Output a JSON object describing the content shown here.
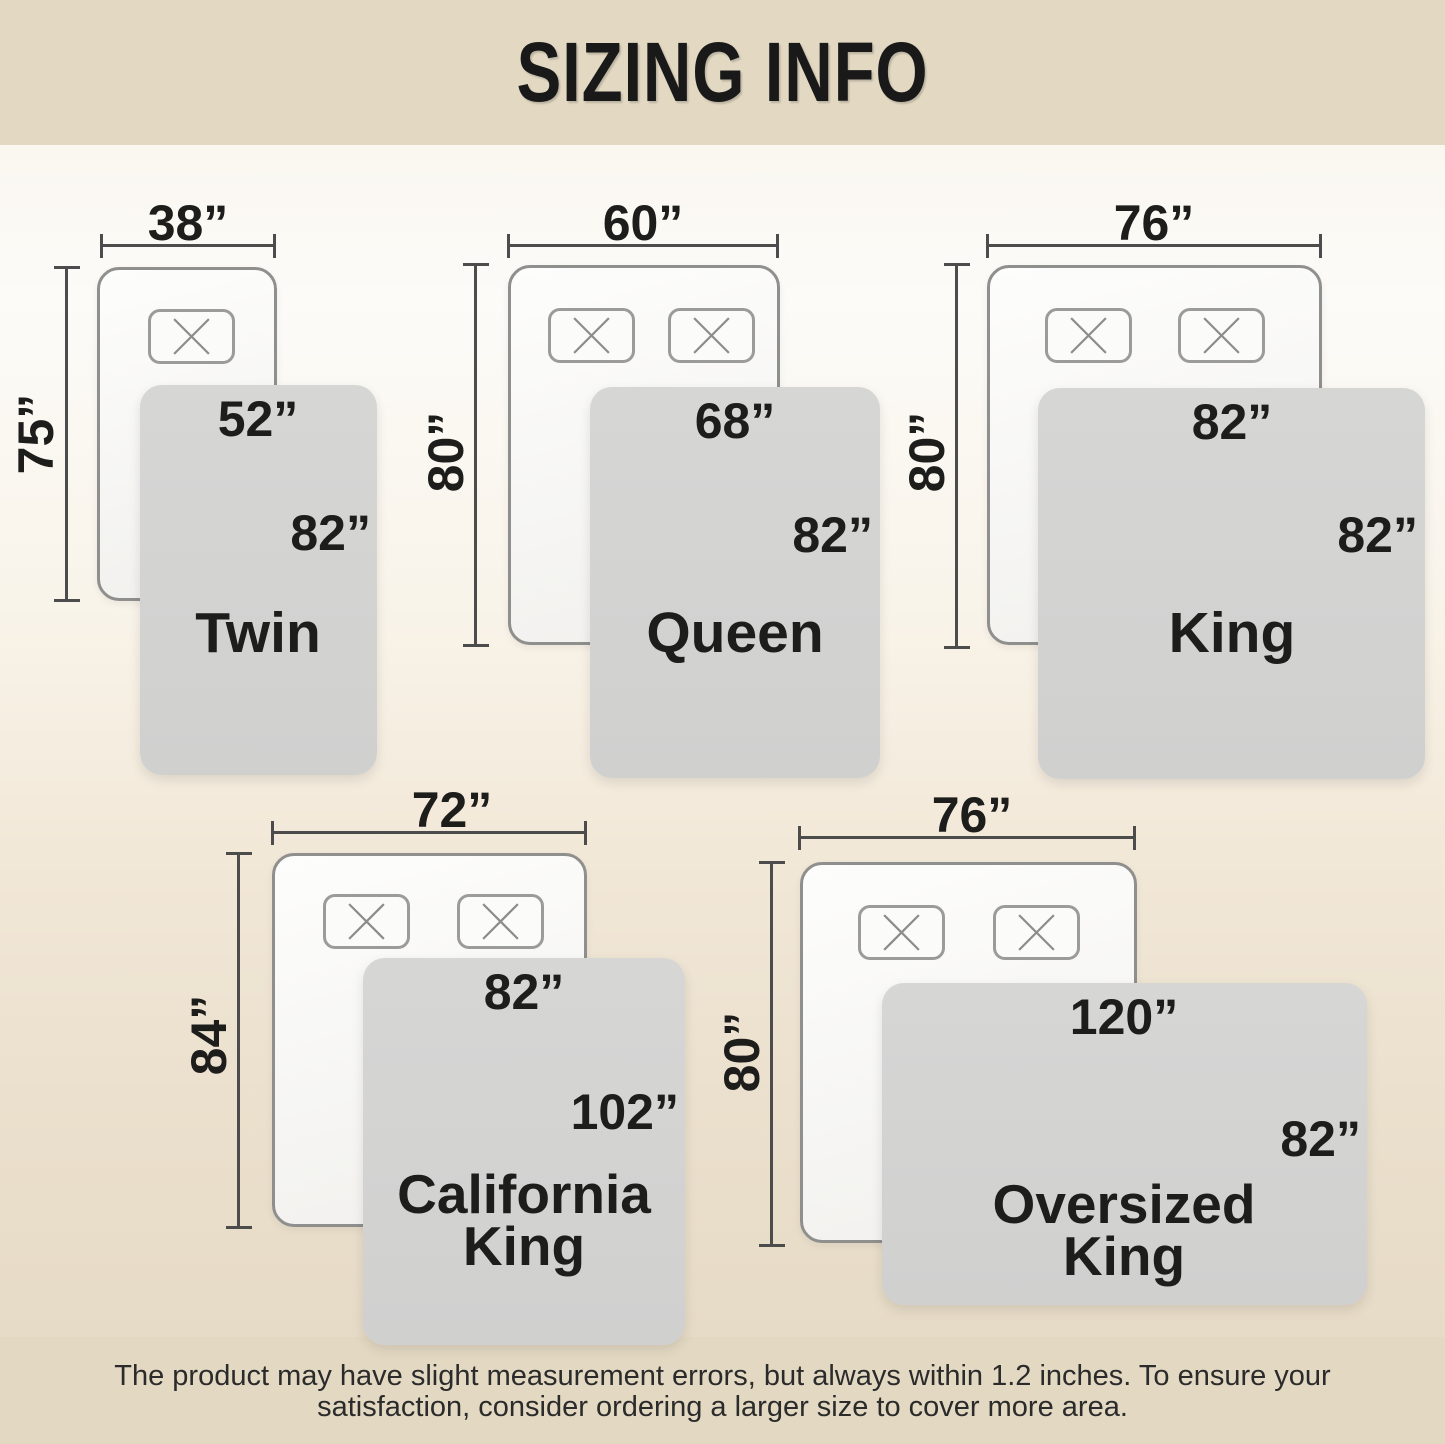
{
  "title": "SIZING INFO",
  "footer": {
    "line1": "The product may have slight measurement errors, but always within 1.2 inches. To ensure your",
    "line2": "satisfaction, consider ordering a larger size to cover more area."
  },
  "colors": {
    "band_beige": "#e3d9c3",
    "blanket_gray": "#d3d3d2",
    "dimension_line": "#4c4c4c",
    "text": "#1d1d1b"
  },
  "beds": [
    {
      "name": "Twin",
      "mattress_width": "38”",
      "mattress_height": "75”",
      "blanket_width": "52”",
      "blanket_height": "82”",
      "pillow_count": 1
    },
    {
      "name": "Queen",
      "mattress_width": "60”",
      "mattress_height": "80”",
      "blanket_width": "68”",
      "blanket_height": "82”",
      "pillow_count": 2
    },
    {
      "name": "King",
      "mattress_width": "76”",
      "mattress_height": "80”",
      "blanket_width": "82”",
      "blanket_height": "82”",
      "pillow_count": 2
    },
    {
      "name_line1": "California",
      "name_line2": "King",
      "mattress_width": "72”",
      "mattress_height": "84”",
      "blanket_width": "82”",
      "blanket_height": "102”",
      "pillow_count": 2
    },
    {
      "name_line1": "Oversized",
      "name_line2": "King",
      "mattress_width": "76”",
      "mattress_height": "80”",
      "blanket_width": "120”",
      "blanket_height": "82”",
      "pillow_count": 2
    }
  ]
}
